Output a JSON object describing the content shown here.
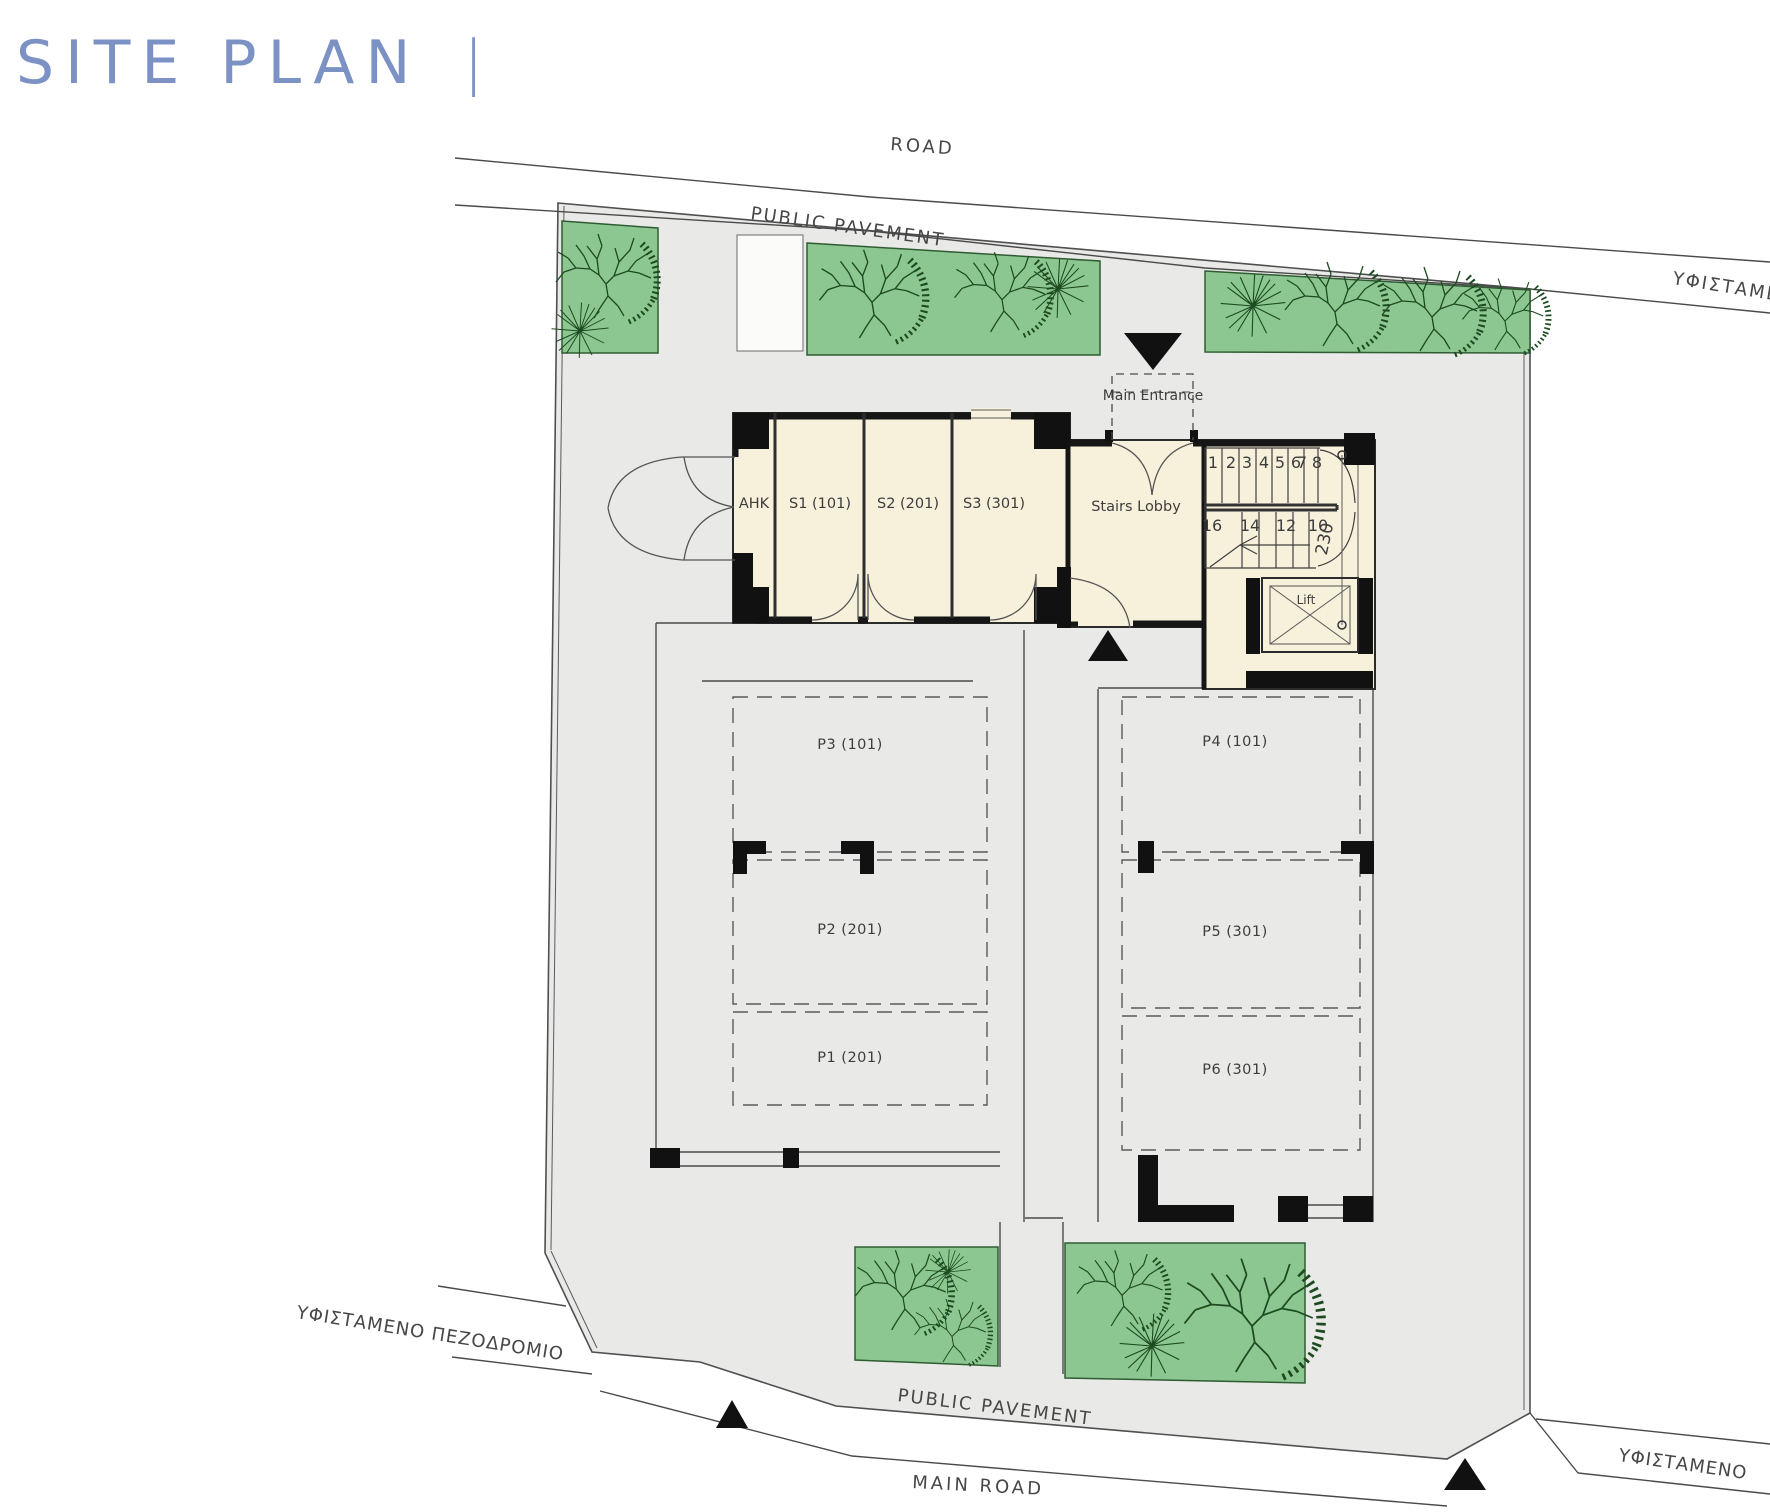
{
  "title": {
    "text": "SITE PLAN",
    "separator": "|"
  },
  "colors": {
    "title": "#7c91c4",
    "site_fill": "#e9eae8",
    "green_fill": "#8cc791",
    "green_stroke": "#2f5c33",
    "tree_stroke": "#1d4a20",
    "building_fill": "#f7f0db",
    "line": "#4a4a4a",
    "wall": "#161616"
  },
  "roads": {
    "top_road": "ROAD",
    "top_pavement": "PUBLIC PAVEMENT",
    "right_existing": "ΥΦΙΣΤΑΜΕΝ",
    "left_existing_pavement": "ΥΦΙΣΤΑΜΕΝΟ  ΠΕΖΟΔΡΟΜΙΟ",
    "bottom_pavement": "PUBLIC PAVEMENT",
    "bottom_main_road": "MAIN ROAD",
    "bottom_right_existing": "ΥΦΙΣΤΑΜΕΝΟ"
  },
  "building": {
    "rooms": [
      {
        "label": "AHK"
      },
      {
        "label": "S1 (101)"
      },
      {
        "label": "S2 (201)"
      },
      {
        "label": "S3 (301)"
      }
    ],
    "stairs_lobby": "Stairs Lobby",
    "main_entrance": "Main Entrance",
    "lift": "Lift",
    "stairs": {
      "up_numbers": [
        "1",
        "2",
        "3",
        "4",
        "5",
        "6",
        "7",
        "8"
      ],
      "down_numbers": [
        "16",
        "14",
        "12",
        "10"
      ],
      "dimension": "230"
    }
  },
  "parking": {
    "left_column": [
      {
        "label": "P3 (101)"
      },
      {
        "label": "P2 (201)"
      },
      {
        "label": "P1 (201)"
      }
    ],
    "right_column": [
      {
        "label": "P4 (101)"
      },
      {
        "label": "P5 (301)"
      },
      {
        "label": "P6 (301)"
      }
    ]
  }
}
